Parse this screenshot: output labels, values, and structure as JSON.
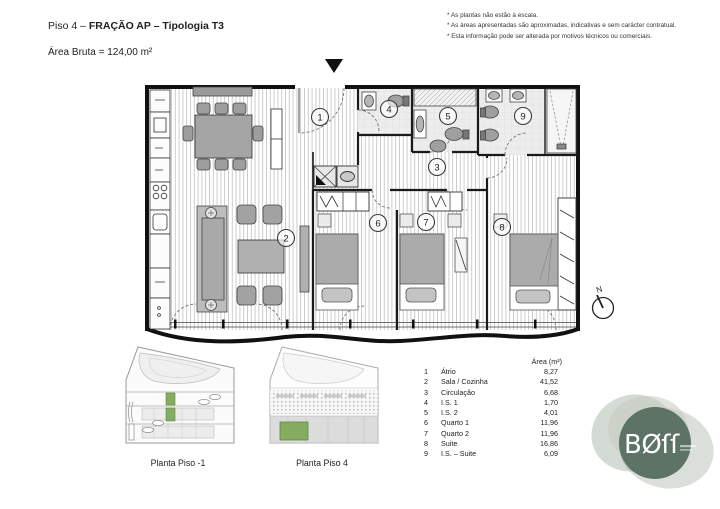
{
  "header": {
    "title_regular": "Piso 4 – ",
    "title_bold": "FRAÇÃO AP – Tipologia T3",
    "subtitle": "Área Bruta = 124,00 m²"
  },
  "notes": [
    "* As plantas não estão à escala.",
    "* As áreas apresentadas são aproximadas, indicativas e sem carácter contratual.",
    "* Esta informação pode ser alterada por motivos técnicos ou comerciais."
  ],
  "plan": {
    "north_label": "N",
    "rooms": [
      {
        "num": "1",
        "name": "Átrio",
        "area": "8,27",
        "x": 320,
        "y": 117
      },
      {
        "num": "2",
        "name": "Sala / Cozinha",
        "area": "41,52",
        "x": 286,
        "y": 238
      },
      {
        "num": "3",
        "name": "Circulação",
        "area": "6,68",
        "x": 437,
        "y": 167
      },
      {
        "num": "4",
        "name": "I.S. 1",
        "area": "1,70",
        "x": 389,
        "y": 109
      },
      {
        "num": "5",
        "name": "I.S. 2",
        "area": "4,01",
        "x": 448,
        "y": 116
      },
      {
        "num": "6",
        "name": "Quarto 1",
        "area": "11,96",
        "x": 378,
        "y": 223
      },
      {
        "num": "7",
        "name": "Quarto 2",
        "area": "11,96",
        "x": 426,
        "y": 222
      },
      {
        "num": "8",
        "name": "Suite",
        "area": "16,86",
        "x": 502,
        "y": 227
      },
      {
        "num": "9",
        "name": "I.S. – Suite",
        "area": "6,09",
        "x": 523,
        "y": 116
      }
    ]
  },
  "legend": {
    "area_header": "Área (m²)"
  },
  "miniplans": [
    {
      "label": "Planta Piso -1"
    },
    {
      "label": "Planta Piso 4"
    }
  ],
  "logo": {
    "text": "BØſſ"
  },
  "colors": {
    "highlight_green": "#85ad62",
    "logo_green": "#5d7365"
  }
}
